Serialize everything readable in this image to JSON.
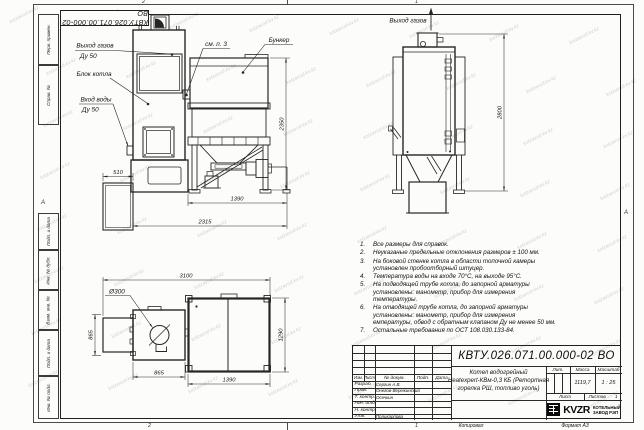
{
  "sheet": {
    "stamp_top": "КВТУ.026.071.00.000-02 ВО",
    "zone_top": [
      "2",
      "1"
    ],
    "zone_bottom": [
      "2",
      "1"
    ],
    "zone_left": "А",
    "zone_right": "А",
    "left_labels": [
      "Перв. примен.",
      "Справ. №",
      "Подп. и дата",
      "Инв. № дубл.",
      "Взам. инв. №",
      "Подп. и дата",
      "Инв. № подл."
    ],
    "footer": {
      "copied": "Копировал",
      "format": "Формат А3"
    }
  },
  "front_view": {
    "labels": {
      "gas_out_1": "Выход газов",
      "gas_out_2": "Ду 50",
      "boiler_block": "Блок котла",
      "water_in_1": "Вход воды",
      "water_in_2": "Ду 50",
      "see_note": "см. п. 3",
      "bunker": "Бункер"
    },
    "dims": {
      "d510": "510",
      "d1390": "1390",
      "d2315": "2315",
      "d2350": "2350"
    }
  },
  "side_view": {
    "labels": {
      "gas_out": "Выход газов"
    },
    "dims": {
      "d2800": "2800"
    }
  },
  "plan_view": {
    "dims": {
      "d3100": "3100",
      "d300": "Ø300",
      "d865_left": "865",
      "d865_bottom": "865",
      "d1290": "1290",
      "d1390": "1390"
    }
  },
  "notes": {
    "items": [
      "Все размеры для справок.",
      "Неуказаные предельные отклонения размеров ± 100 мм.",
      "На боковой стенке котла в области топочной камеры установлен пробоотборный штуцер.",
      "Температура воды на входе 70°С, на выходе 95°С.",
      "На подводящей трубе котла, до запорной арматуры установлены: манометр, прибор для измерения температуры.",
      "На отводящей трубе котла, до запорной арматуры установлены: манометр, прибор для измерения емпературы, обвод с обратным клапаном Ду не менее 50 мм.",
      "Остальные требования по ОСТ 108.030.133-84."
    ]
  },
  "title_block": {
    "doc_number": "КВТУ.026.071.00.000-02 ВО",
    "product_name": [
      "Котел водогрейный",
      "Heatexpert-КВм-0,3 КБ (Ретортная",
      "горелка РШ, топливо уголь)"
    ],
    "rev_header": [
      "Изм.",
      "Лист",
      "№ докум.",
      "Подп.",
      "Дата"
    ],
    "signature_rows": [
      {
        "role": "Разраб.",
        "name": "Сергин А.В."
      },
      {
        "role": "Пров.",
        "name": "Онегов-Вережинский"
      },
      {
        "role": "Т. контр.",
        "name": "Осечкин"
      },
      {
        "role": "Нач. отд.",
        "name": ""
      },
      {
        "role": "Н. контр.",
        "name": ""
      },
      {
        "role": "Утв.",
        "name": "Поликарпова"
      }
    ],
    "lit_label": "Лит.",
    "mass_label": "Масса",
    "mass_value": "1119,7",
    "scale_label": "Масштаб",
    "scale_value": "1 : 25",
    "sheet_label": "Лист",
    "sheets_label": "Листов",
    "sheets_value": "1",
    "company": {
      "abbr": "KVZR",
      "line1": "КОТЕЛЬНЫЙ",
      "line2": "ЗАВОД РЭП"
    }
  },
  "watermark": {
    "text": "kotzavod-kv.kz"
  }
}
